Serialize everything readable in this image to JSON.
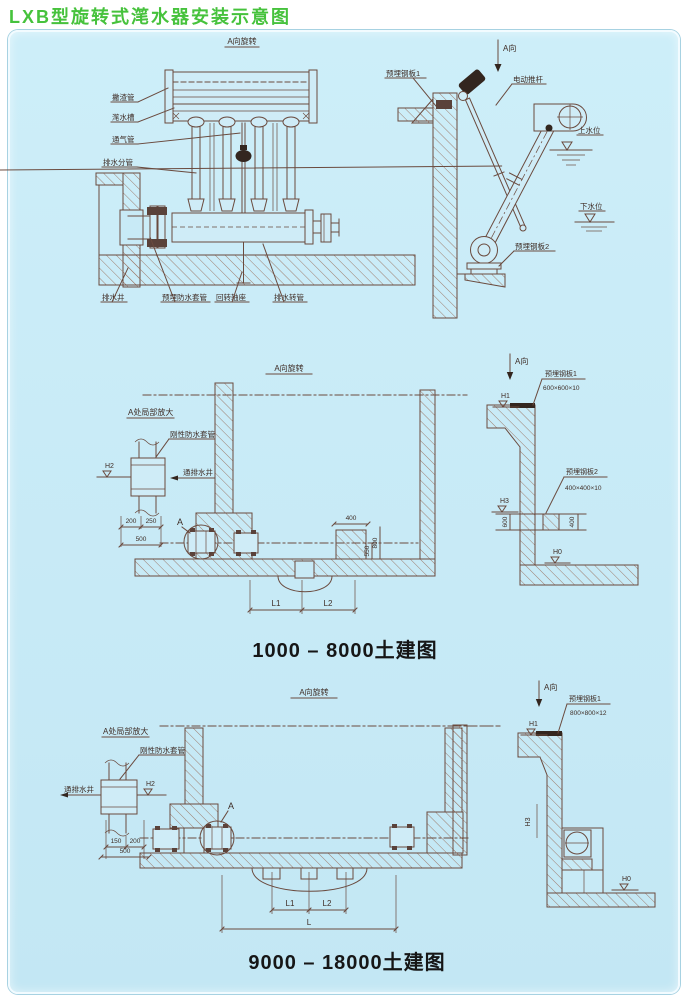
{
  "page": {
    "title": "LXB型旋转式滗水器安装示意图"
  },
  "palette": {
    "title_green": "#46c23c",
    "panel_blue": "#c8eaf6",
    "line_brown": "#6a4a3e",
    "ink": "#3f2d26"
  },
  "assembly_view": {
    "view_label": "A向旋转",
    "left_labels": [
      "撇渣管",
      "滗水槽",
      "通气管",
      "排水分管"
    ],
    "bottom_labels": [
      "排水井",
      "预埋防水套管",
      "回转轴座",
      "排水转管"
    ]
  },
  "side_view": {
    "direction_label": "A向",
    "embedded_plate_1": "预埋钢板1",
    "actuator": "电动推杆",
    "upper_water_level": "上水位",
    "lower_water_level": "下水位",
    "embedded_plate_2": "预埋钢板2"
  },
  "civil_1000_8000": {
    "view_label": "A向旋转",
    "direction_label": "A向",
    "detail_title": "A处局部放大",
    "rigid_sleeve": "刚性防水套管",
    "to_drain_well": "通排水井",
    "detail_marker": "A",
    "embedded_plate_1": "预埋钢板1",
    "plate_1_size": "600×600×10",
    "embedded_plate_2": "预埋钢板2",
    "plate_2_size": "400×400×10",
    "levels": {
      "h1": "H1",
      "h2": "H2",
      "h3": "H3",
      "h0": "H0"
    },
    "dims": {
      "w200": "200",
      "w250": "250",
      "w500": "500",
      "ped_w": "400",
      "ped_h": "550",
      "ped_h2": "800",
      "br_v": "600",
      "br_v2": "400",
      "l1": "L1",
      "l2": "L2"
    },
    "caption": "1000 – 8000土建图"
  },
  "civil_9000_18000": {
    "view_label": "A向旋转",
    "direction_label": "A向",
    "detail_title": "A处局部放大",
    "rigid_sleeve": "刚性防水套管",
    "to_drain_well": "通排水井",
    "detail_marker": "A",
    "embedded_plate_1": "预埋钢板1",
    "plate_1_size": "800×800×12",
    "levels": {
      "h1": "H1",
      "h2": "H2",
      "h3": "H3",
      "h0": "H0"
    },
    "dims": {
      "w150": "150",
      "w200": "200",
      "w500": "500",
      "l1": "L1",
      "l2": "L2",
      "l": "L"
    },
    "caption": "9000 – 18000土建图"
  }
}
